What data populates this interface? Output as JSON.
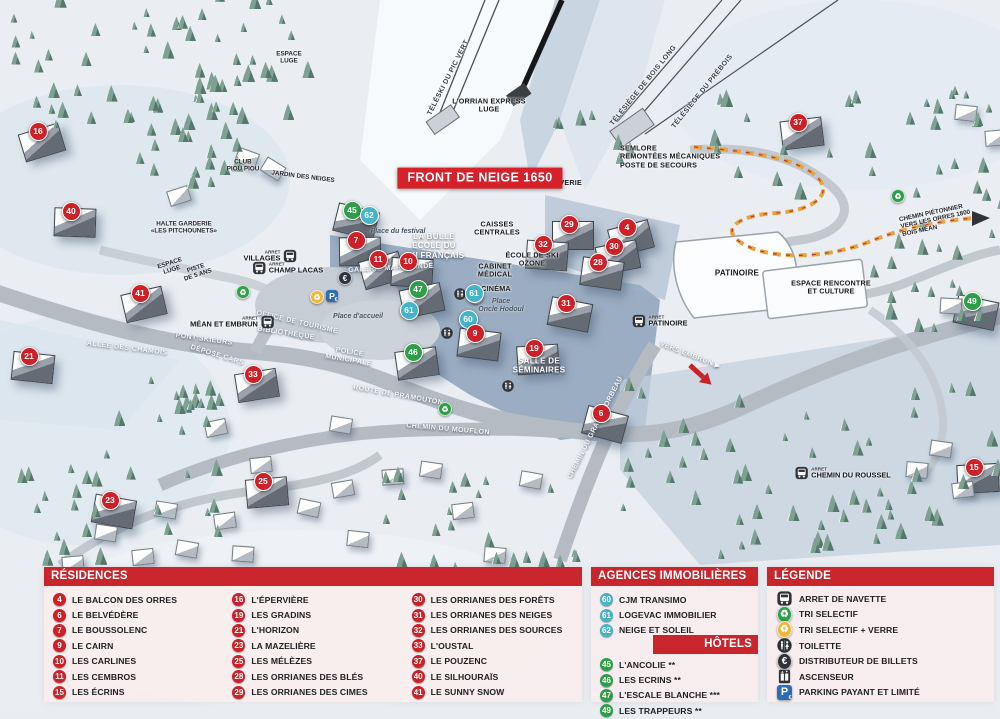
{
  "colors": {
    "red": "#cf2027",
    "teal": "#45b4c8",
    "green": "#2e9e49",
    "bar": "#c9252c",
    "banner": "#d6202a",
    "parking_blue": "#2d6db5",
    "recycle_yellow": "#edb73d",
    "icon_dark": "#2f3338",
    "path_orange": "#e8a33e"
  },
  "map": {
    "banner": "FRONT DE NEIGE 1650",
    "arret": "ARRET",
    "markers": [
      {
        "n": "16",
        "x": 37,
        "y": 130,
        "c": "red"
      },
      {
        "n": "40",
        "x": 70,
        "y": 210,
        "c": "red"
      },
      {
        "n": "41",
        "x": 139,
        "y": 292,
        "c": "red"
      },
      {
        "n": "21",
        "x": 28,
        "y": 355,
        "c": "red"
      },
      {
        "n": "33",
        "x": 252,
        "y": 373,
        "c": "red"
      },
      {
        "n": "23",
        "x": 109,
        "y": 499,
        "c": "red"
      },
      {
        "n": "25",
        "x": 262,
        "y": 480,
        "c": "red"
      },
      {
        "n": "45",
        "x": 351,
        "y": 209,
        "c": "green"
      },
      {
        "n": "62",
        "x": 368,
        "y": 214,
        "c": "blue"
      },
      {
        "n": "7",
        "x": 355,
        "y": 239,
        "c": "red"
      },
      {
        "n": "11",
        "x": 377,
        "y": 258,
        "c": "red"
      },
      {
        "n": "10",
        "x": 407,
        "y": 260,
        "c": "red"
      },
      {
        "n": "47",
        "x": 417,
        "y": 288,
        "c": "green"
      },
      {
        "n": "61",
        "x": 408,
        "y": 309,
        "c": "blue"
      },
      {
        "n": "61",
        "x": 473,
        "y": 292,
        "c": "blue"
      },
      {
        "n": "60",
        "x": 467,
        "y": 318,
        "c": "blue"
      },
      {
        "n": "9",
        "x": 474,
        "y": 332,
        "c": "red"
      },
      {
        "n": "46",
        "x": 412,
        "y": 351,
        "c": "green"
      },
      {
        "n": "31",
        "x": 565,
        "y": 302,
        "c": "red"
      },
      {
        "n": "19",
        "x": 533,
        "y": 347,
        "c": "red"
      },
      {
        "n": "6",
        "x": 600,
        "y": 412,
        "c": "red"
      },
      {
        "n": "29",
        "x": 568,
        "y": 223,
        "c": "red"
      },
      {
        "n": "4",
        "x": 626,
        "y": 226,
        "c": "red"
      },
      {
        "n": "32",
        "x": 542,
        "y": 243,
        "c": "red"
      },
      {
        "n": "30",
        "x": 613,
        "y": 245,
        "c": "red"
      },
      {
        "n": "28",
        "x": 597,
        "y": 261,
        "c": "red"
      },
      {
        "n": "37",
        "x": 797,
        "y": 121,
        "c": "red"
      },
      {
        "n": "49",
        "x": 971,
        "y": 300,
        "c": "green"
      },
      {
        "n": "15",
        "x": 973,
        "y": 466,
        "c": "red"
      }
    ],
    "labels": [
      {
        "t": "FRONT DE NEIGE 1650",
        "x": 480,
        "y": 178,
        "s": "banner"
      },
      {
        "t": "TÉLÉSKI DU PIC VERT",
        "x": 449,
        "y": 78,
        "r": -63,
        "s": "lift"
      },
      {
        "t": "L'ORRIAN EXPRESS\nLUGE",
        "x": 489,
        "y": 106,
        "s": "dk7"
      },
      {
        "t": "TÉLÉSIÈGE DE BOIS LONG",
        "x": 644,
        "y": 86,
        "r": -51,
        "s": "lift"
      },
      {
        "t": "TÉLÉSIÈGE DU PRÉBOIS",
        "x": 703,
        "y": 92,
        "r": -51,
        "s": "lift"
      },
      {
        "t": "SEMLORE\nREMONTÉES MÉCANIQUES\nPOSTE DE SECOURS",
        "x": 620,
        "y": 157,
        "s": "dk7",
        "a": "l"
      },
      {
        "t": "LAVERIE",
        "x": 566,
        "y": 183,
        "s": "dk7"
      },
      {
        "t": "CAISSES\nCENTRALES",
        "x": 497,
        "y": 229,
        "s": "dk7"
      },
      {
        "t": "LA BULLE\nÉCOLE DU\nSKI FRANÇAIS",
        "x": 434,
        "y": 246,
        "s": "wh8"
      },
      {
        "t": "ÉCOLE DE SKI\nOZONE",
        "x": 532,
        "y": 260,
        "s": "dk7"
      },
      {
        "t": "CABINET\nMÉDICAL",
        "x": 495,
        "y": 271,
        "s": "dk7"
      },
      {
        "t": "CINÉMA",
        "x": 496,
        "y": 289,
        "s": "dk7"
      },
      {
        "t": "Place\nOncle Hodoul",
        "x": 501,
        "y": 306,
        "s": "it7"
      },
      {
        "t": "Place du festival",
        "x": 398,
        "y": 232,
        "s": "it7"
      },
      {
        "t": "Place d'accueil",
        "x": 358,
        "y": 317,
        "s": "it7"
      },
      {
        "t": "GALERIE MARCHANDE",
        "x": 391,
        "y": 269,
        "r": -3,
        "s": "wh7"
      },
      {
        "t": "OFFICE DE TOURISME",
        "x": 297,
        "y": 323,
        "r": 13,
        "s": "wh7"
      },
      {
        "t": "BIBLIOTHÈQUE",
        "x": 286,
        "y": 334,
        "r": 9,
        "s": "wh7"
      },
      {
        "t": "PONT SKIEURS",
        "x": 204,
        "y": 340,
        "r": 8,
        "s": "wh7"
      },
      {
        "t": "DÉPOSE CARS",
        "x": 217,
        "y": 356,
        "r": 17,
        "s": "wh7"
      },
      {
        "t": "POLICE\nMUNICIPALE",
        "x": 349,
        "y": 357,
        "r": 9,
        "s": "wh7"
      },
      {
        "t": "ALLÉE DES CHAMOIS",
        "x": 127,
        "y": 349,
        "r": 7,
        "s": "wh7"
      },
      {
        "t": "ROUTE DE PRAMOUTON",
        "x": 398,
        "y": 396,
        "r": 10,
        "s": "wh7"
      },
      {
        "t": "CHEMIN DU MOUFLON",
        "x": 448,
        "y": 430,
        "r": 5,
        "s": "wh7"
      },
      {
        "t": "CHEMIN DU GRAND CORBEAU",
        "x": 596,
        "y": 428,
        "r": -63,
        "s": "wh7"
      },
      {
        "t": "VERS EMBRUN ▶",
        "x": 690,
        "y": 356,
        "r": 21,
        "s": "wh7"
      },
      {
        "t": "SALLE DE\nSÉMINAIRES",
        "x": 539,
        "y": 366,
        "s": "wh8"
      },
      {
        "t": "PATINOIRE",
        "x": 737,
        "y": 273,
        "s": "dk8"
      },
      {
        "t": "ESPACE RENCONTRE\nET CULTURE",
        "x": 831,
        "y": 288,
        "s": "dk7"
      },
      {
        "t": "CHEMIN PIÉTONNIER\nVERS LES ORRES 1800\nBOIS MÉAN",
        "x": 900,
        "y": 220,
        "r": -12,
        "s": "dk6",
        "a": "l"
      },
      {
        "t": "HALTE GARDERIE\n«LES PITCHOUNETS»",
        "x": 184,
        "y": 228,
        "s": "dk6"
      },
      {
        "t": "CLUB\nPIOU PIOU",
        "x": 243,
        "y": 166,
        "s": "dk6"
      },
      {
        "t": "JARDIN DES NEIGES",
        "x": 303,
        "y": 177,
        "r": 7,
        "s": "dk6"
      },
      {
        "t": "ESPACE\nLUGE",
        "x": 289,
        "y": 58,
        "s": "dk6"
      },
      {
        "t": "ESPACE\nLUGE",
        "x": 171,
        "y": 267,
        "r": -18,
        "s": "dk6"
      },
      {
        "t": "PISTE\nDE 5 ANS",
        "x": 197,
        "y": 272,
        "r": -18,
        "s": "dk6"
      }
    ],
    "icons": [
      {
        "type": "recycle-green",
        "x": 243,
        "y": 292
      },
      {
        "type": "recycle-green",
        "x": 445,
        "y": 409
      },
      {
        "type": "recycle-green",
        "x": 898,
        "y": 196
      },
      {
        "type": "recycle-yellow",
        "x": 317,
        "y": 297
      },
      {
        "type": "parking",
        "x": 332,
        "y": 296
      },
      {
        "type": "atm",
        "x": 345,
        "y": 278
      },
      {
        "type": "atm",
        "x": 476,
        "y": 297
      },
      {
        "type": "toilet",
        "x": 460,
        "y": 296
      },
      {
        "type": "toilet",
        "x": 447,
        "y": 335
      },
      {
        "type": "toilet",
        "x": 508,
        "y": 388
      }
    ],
    "bus_stops": [
      {
        "name": "VILLAGES",
        "x": 270,
        "y": 256,
        "side": "left"
      },
      {
        "name": "CHAMP LACAS",
        "x": 288,
        "y": 268,
        "side": "right"
      },
      {
        "name": "MÉAN ET EMBRUN",
        "x": 232,
        "y": 322,
        "side": "left"
      },
      {
        "name": "PATINOIRE",
        "x": 660,
        "y": 321,
        "side": "right"
      },
      {
        "name": "CHEMIN DU ROUSSEL",
        "x": 843,
        "y": 473,
        "side": "right"
      }
    ]
  },
  "legend": {
    "residences": {
      "title": "RÉSIDENCES",
      "items": [
        {
          "n": "4",
          "label": "LE BALCON DES ORRES"
        },
        {
          "n": "6",
          "label": "LE BELVÉDÈRE"
        },
        {
          "n": "7",
          "label": "LE BOUSSOLENC"
        },
        {
          "n": "9",
          "label": "LE CAIRN"
        },
        {
          "n": "10",
          "label": "LES CARLINES"
        },
        {
          "n": "11",
          "label": "LES CEMBROS"
        },
        {
          "n": "15",
          "label": "LES ÉCRINS"
        },
        {
          "n": "16",
          "label": "L'ÉPERVIÈRE"
        },
        {
          "n": "19",
          "label": "LES GRADINS"
        },
        {
          "n": "21",
          "label": "L'HORIZON"
        },
        {
          "n": "23",
          "label": "LA MAZELIÈRE"
        },
        {
          "n": "25",
          "label": "LES MÉLÈZES"
        },
        {
          "n": "28",
          "label": "LES ORRIANES DES BLÉS"
        },
        {
          "n": "29",
          "label": "LES ORRIANES DES CIMES"
        },
        {
          "n": "30",
          "label": "LES ORRIANES DES FORÊTS"
        },
        {
          "n": "31",
          "label": "LES ORRIANES DES NEIGES"
        },
        {
          "n": "32",
          "label": "LES ORRIANES DES SOURCES"
        },
        {
          "n": "33",
          "label": "L'OUSTAL"
        },
        {
          "n": "37",
          "label": "LE POUZENC"
        },
        {
          "n": "40",
          "label": "LE SILHOURAÏS"
        },
        {
          "n": "41",
          "label": "LE SUNNY SNOW"
        }
      ]
    },
    "agences": {
      "title": "AGENCES IMMOBILIÈRES",
      "items": [
        {
          "n": "60",
          "label": "CJM TRANSIMO"
        },
        {
          "n": "61",
          "label": "LOGEVAC IMMOBILIER"
        },
        {
          "n": "62",
          "label": "NEIGE ET SOLEIL"
        }
      ]
    },
    "hotels": {
      "title": "HÔTELS",
      "items": [
        {
          "n": "45",
          "label": "L'ANCOLIE **"
        },
        {
          "n": "46",
          "label": "LES ECRINS **"
        },
        {
          "n": "47",
          "label": "L'ESCALE BLANCHE ***"
        },
        {
          "n": "49",
          "label": "LES TRAPPEURS **"
        }
      ]
    },
    "legende": {
      "title": "LÉGENDE",
      "items": [
        {
          "icon": "bus",
          "label": "ARRET DE NAVETTE"
        },
        {
          "icon": "recycle-green",
          "label": "TRI SELECTIF"
        },
        {
          "icon": "recycle-yellow",
          "label": "TRI SELECTIF + VERRE"
        },
        {
          "icon": "toilet",
          "label": "TOILETTE"
        },
        {
          "icon": "atm",
          "label": "DISTRIBUTEUR DE BILLETS"
        },
        {
          "icon": "elevator",
          "label": "ASCENSEUR"
        },
        {
          "icon": "parking",
          "label": "PARKING PAYANT ET LIMITÉ"
        }
      ]
    }
  }
}
